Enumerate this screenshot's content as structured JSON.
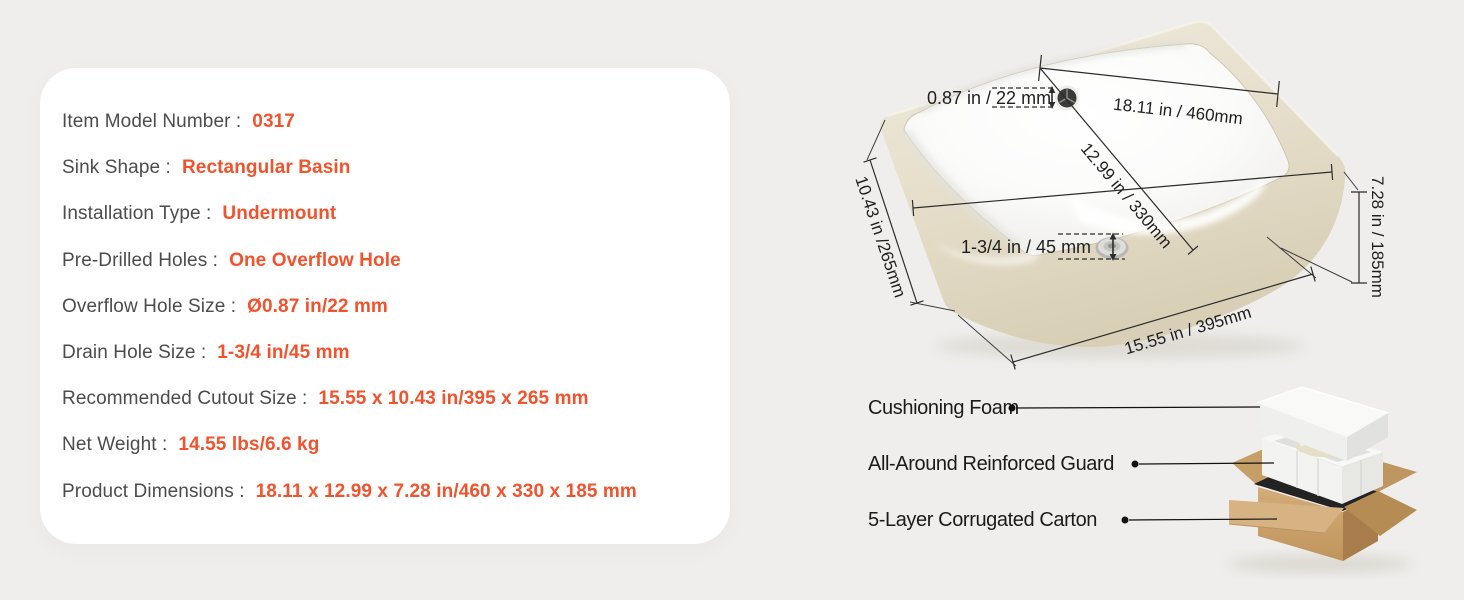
{
  "colors": {
    "background": "#efeeec",
    "card_background": "#ffffff",
    "accent_orange": "#f2532c",
    "label_gray": "#4c4c4c",
    "diagram_line": "#2c2c2c",
    "rim_beige": "#e9e3d3",
    "carton_tan": "#cca36b",
    "foam_white": "#f5f5f4"
  },
  "spec_card": {
    "rows": [
      {
        "label": "Item Model Number :",
        "value": "0317"
      },
      {
        "label": "Sink Shape :",
        "value": "Rectangular Basin"
      },
      {
        "label": "Installation Type :",
        "value": "Undermount"
      },
      {
        "label": "Pre-Drilled Holes :",
        "value": "One Overflow Hole"
      },
      {
        "label": "Overflow Hole Size :",
        "value": "Ø0.87 in/22 mm"
      },
      {
        "label": "Drain Hole Size :",
        "value": "1-3/4 in/45 mm"
      },
      {
        "label": "Recommended Cutout Size :",
        "value": "15.55 x 10.43 in/395 x 265 mm"
      },
      {
        "label": "Net Weight :",
        "value": "14.55 lbs/6.6 kg"
      },
      {
        "label": "Product Dimensions :",
        "value": "18.11 x 12.99 x 7.28 in/460 x 330 x 185 mm"
      }
    ]
  },
  "sink_diagram": {
    "overflow_size_label": "0.87 in / 22 mm",
    "drain_size_label": "1-3/4 in / 45 mm",
    "length_label": "18.11 in / 460mm",
    "width_label": "12.99 in / 330mm",
    "cutout_width_label": "10.43 in /265mm",
    "cutout_length_label": "15.55 in / 395mm",
    "height_label": "7.28 in / 185mm"
  },
  "packaging": {
    "labels": [
      {
        "text": "Cushioning Foam"
      },
      {
        "text": "All-Around Reinforced Guard"
      },
      {
        "text": "5-Layer Corrugated Carton"
      }
    ]
  }
}
